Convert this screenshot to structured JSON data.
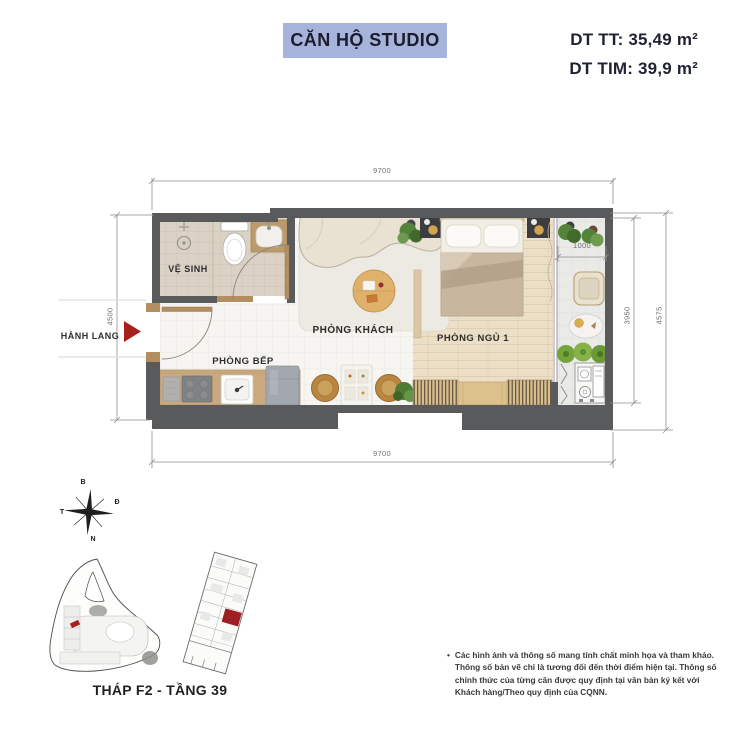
{
  "header": {
    "title": "CĂN HỘ STUDIO",
    "area_tt": "DT TT: 35,49 m²",
    "area_tim": "DT TIM: 39,9 m²"
  },
  "plan": {
    "rooms": {
      "bathroom": "VỆ SINH",
      "living": "PHÒNG KHÁCH",
      "kitchen": "PHÒNG BẾP",
      "bedroom": "PHÒNG NGỦ 1"
    },
    "corridor": "HÀNH LANG",
    "dims": {
      "top": "9700",
      "bottom": "9700",
      "left": "4500",
      "balcony": "1000",
      "right_inner": "3950",
      "right_outer": "4575"
    }
  },
  "compass": {
    "north": "B",
    "east": "Đ",
    "west": "T",
    "south": "N"
  },
  "footer": {
    "tower": "THÁP F2 - TẦNG 39",
    "disclaimer_bullet": "•",
    "disclaimer": "Các hình ảnh và thông số mang tính chất minh họa và tham khảo. Thông số bản vẽ chỉ là tương đối đến thời điểm hiện tại. Thông số chính thức của từng căn được quy định tại văn bản ký kết với Khách hàng/Theo quy định của CQNN."
  },
  "colors": {
    "title_bg": "#a6b3da",
    "heading_text": "#1e2234",
    "wall": "#595a5c",
    "marker_red": "#a8201d",
    "wood": "#c9a87d",
    "plant_green": "#5d8c3e"
  }
}
